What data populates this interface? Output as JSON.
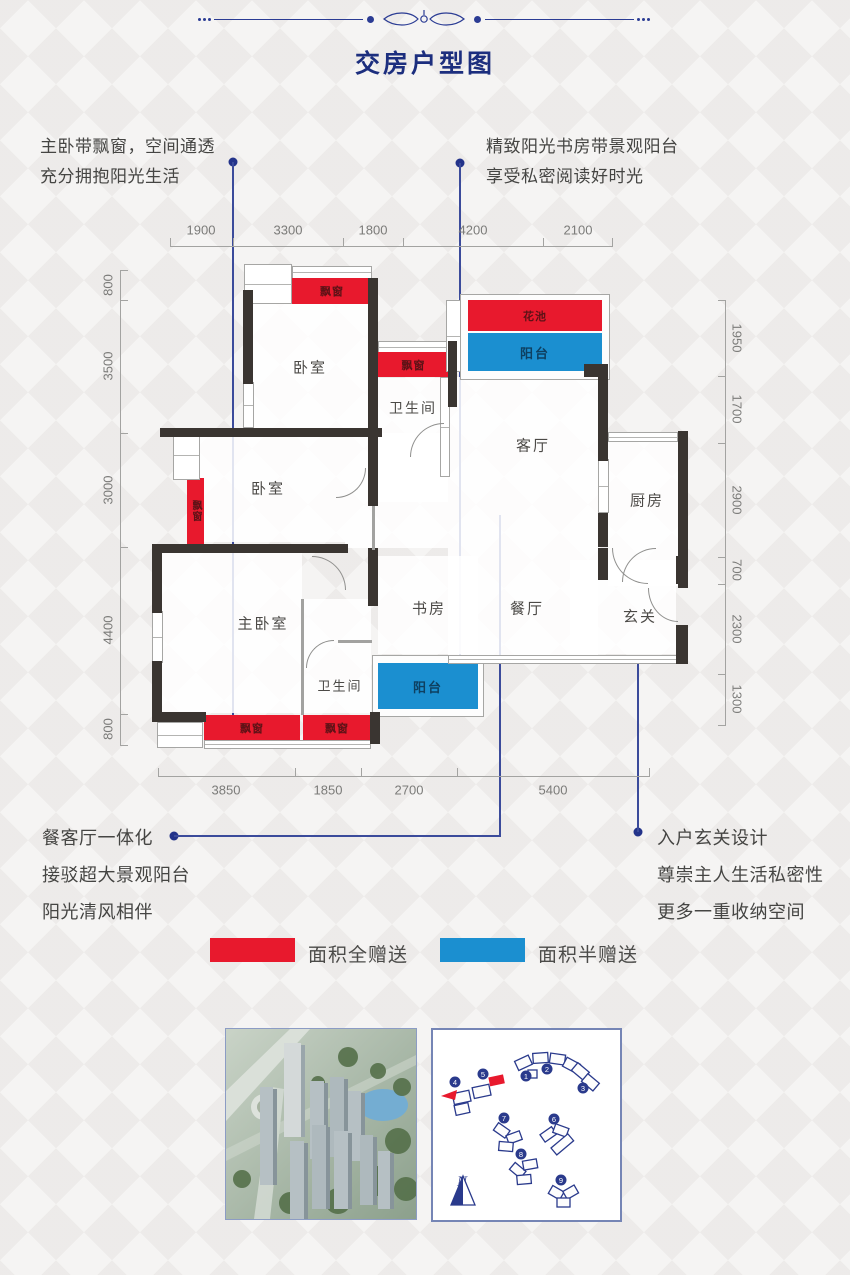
{
  "title": "交房户型图",
  "annotations": {
    "top_left": {
      "line1": "主卧带飘窗，空间通透",
      "line2": "充分拥抱阳光生活"
    },
    "top_right": {
      "line1": "精致阳光书房带景观阳台",
      "line2": "享受私密阅读好时光"
    },
    "bottom_left": {
      "line1": "餐客厅一体化",
      "line2": "接驳超大景观阳台",
      "line3": "阳光清风相伴"
    },
    "bottom_right": {
      "line1": "入户玄关设计",
      "line2": "尊崇主人生活私密性",
      "line3": "更多一重收纳空间"
    }
  },
  "dimensions": {
    "top": [
      "1900",
      "3300",
      "1800",
      "4200",
      "2100"
    ],
    "bottom": [
      "3850",
      "1850",
      "2700",
      "5400"
    ],
    "left": [
      "800",
      "3500",
      "3000",
      "4400",
      "800"
    ],
    "right": [
      "1950",
      "1700",
      "2900",
      "700",
      "2300",
      "1300"
    ]
  },
  "rooms": {
    "bedroom_top": "卧室",
    "bedroom_mid": "卧室",
    "master_bedroom": "主卧室",
    "bathroom_top": "卫生间",
    "bathroom_bottom": "卫生间",
    "living": "客厅",
    "dining": "餐厅",
    "kitchen": "厨房",
    "study": "书房",
    "entry": "玄关",
    "flower_bed": "花池",
    "balcony_top": "阳台",
    "balcony_bottom": "阳台",
    "bay_window": "飘窗"
  },
  "legend": {
    "full_gift": {
      "label": "面积全赠送",
      "color": "#e8192d"
    },
    "half_gift": {
      "label": "面积半赠送",
      "color": "#1b8fd0"
    }
  },
  "site_plan": {
    "compass": "N",
    "buildings": [
      "1",
      "2",
      "3",
      "4",
      "5",
      "6",
      "7",
      "8",
      "9"
    ]
  },
  "colors": {
    "red": "#e8192d",
    "blue": "#1b8fd0",
    "wall": "#3a3531",
    "navy": "#23338a"
  }
}
